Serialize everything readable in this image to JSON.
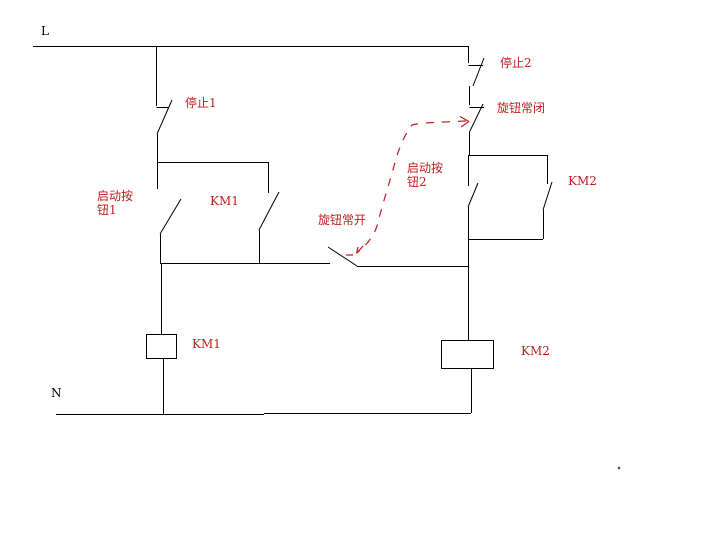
{
  "colors": {
    "background": "#ffffff",
    "wire": "#000000",
    "annotation_red": "#c02020"
  },
  "diagram": {
    "rails": {
      "live_label": "L",
      "neutral_label": "N"
    },
    "contacts": {
      "stop1_label": "停止1",
      "stop2_label": "停止2",
      "knob_nc_label": "旋钮常闭",
      "knob_no_label": "旋钮常开",
      "start1_label": "启动按\n钮1",
      "start2_label": "启动按\n钮2",
      "km1_aux_label": "KM1",
      "km2_aux_label": "KM2"
    },
    "coils": {
      "km1_label": "KM1",
      "km2_label": "KM2"
    }
  }
}
